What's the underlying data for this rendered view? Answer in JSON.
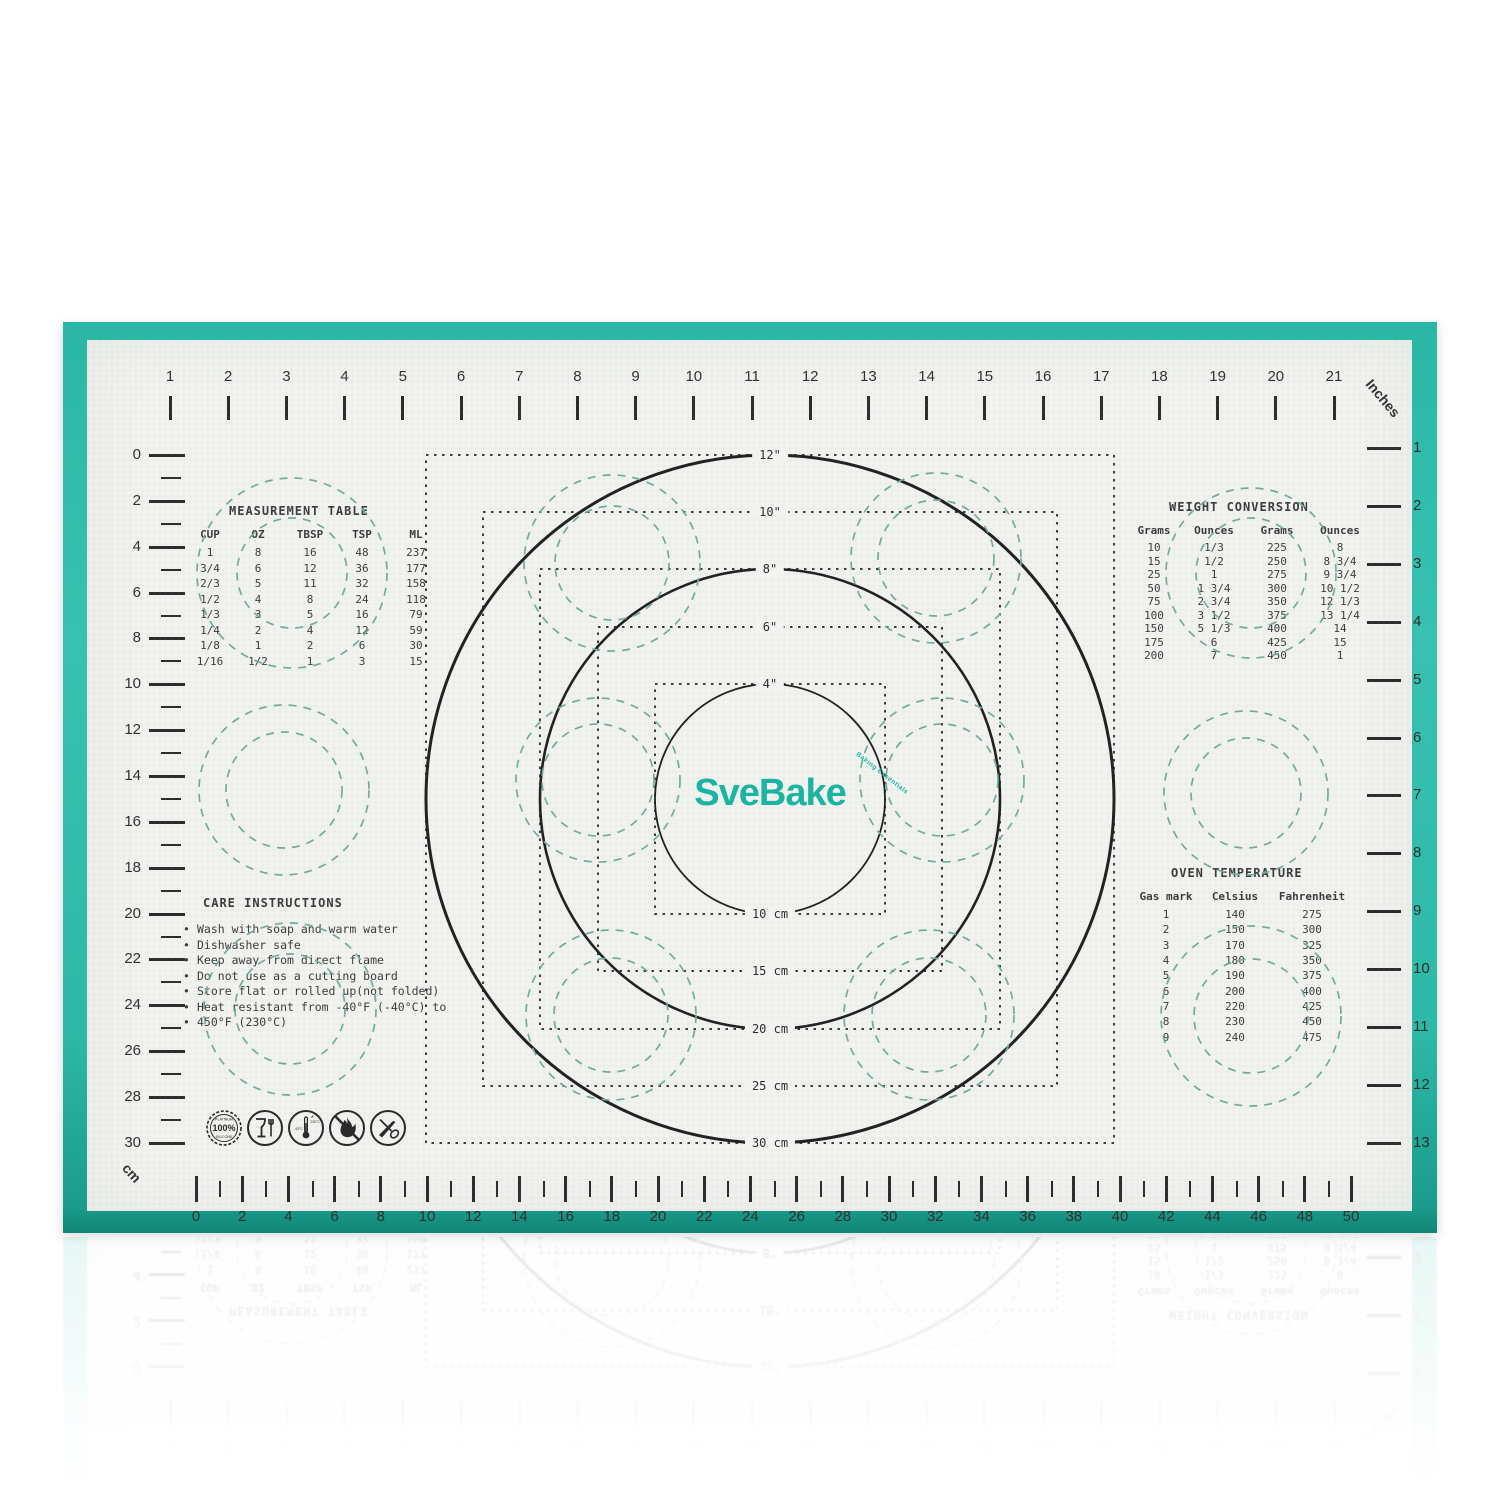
{
  "product": {
    "brand": "SveBake",
    "tagline": "Baking Essentials"
  },
  "colors": {
    "teal_border": "#2eb8a7",
    "mat_surface": "#f2f3f0",
    "ink": "#3a3a3a",
    "teal_dashed": "#76a99a",
    "logo_teal": "#1cb3a2"
  },
  "rulers": {
    "top_inches": {
      "unit_label": "Inches",
      "values": [
        1,
        2,
        3,
        4,
        5,
        6,
        7,
        8,
        9,
        10,
        11,
        12,
        13,
        14,
        15,
        16,
        17,
        18,
        19,
        20,
        21
      ]
    },
    "right_inches": {
      "values": [
        1,
        2,
        3,
        4,
        5,
        6,
        7,
        8,
        9,
        10,
        11,
        12,
        13
      ]
    },
    "left_cm": {
      "values": [
        0,
        2,
        4,
        6,
        8,
        10,
        12,
        14,
        16,
        18,
        20,
        22,
        24,
        26,
        28,
        30
      ]
    },
    "bottom_cm": {
      "unit_label": "cm",
      "values": [
        0,
        2,
        4,
        6,
        8,
        10,
        12,
        14,
        16,
        18,
        20,
        22,
        24,
        26,
        28,
        30,
        32,
        34,
        36,
        38,
        40,
        42,
        44,
        46,
        48,
        50
      ]
    }
  },
  "circle_labels": {
    "inches": [
      "12\"",
      "10\"",
      "8\"",
      "6\"",
      "4\""
    ],
    "cm": [
      "10 cm",
      "15 cm",
      "20 cm",
      "25 cm",
      "30 cm"
    ]
  },
  "measurement_table": {
    "title": "MEASUREMENT TABLE",
    "headers": [
      "CUP",
      "OZ",
      "TBSP",
      "TSP",
      "ML"
    ],
    "rows": [
      [
        "1",
        "8",
        "16",
        "48",
        "237"
      ],
      [
        "3/4",
        "6",
        "12",
        "36",
        "177"
      ],
      [
        "2/3",
        "5",
        "11",
        "32",
        "158"
      ],
      [
        "1/2",
        "4",
        "8",
        "24",
        "118"
      ],
      [
        "1/3",
        "3",
        "5",
        "16",
        "79"
      ],
      [
        "1/4",
        "2",
        "4",
        "12",
        "59"
      ],
      [
        "1/8",
        "1",
        "2",
        "6",
        "30"
      ],
      [
        "1/16",
        "1/2",
        "1",
        "3",
        "15"
      ]
    ]
  },
  "weight_conversion": {
    "title": "WEIGHT CONVERSION",
    "headers": [
      "Grams",
      "Ounces",
      "Grams",
      "Ounces"
    ],
    "rows": [
      [
        "10",
        "1/3",
        "225",
        "8"
      ],
      [
        "15",
        "1/2",
        "250",
        "8 3/4"
      ],
      [
        "25",
        "1",
        "275",
        "9 3/4"
      ],
      [
        "50",
        "1 3/4",
        "300",
        "10 1/2"
      ],
      [
        "75",
        "2 3/4",
        "350",
        "12 1/3"
      ],
      [
        "100",
        "3 1/2",
        "375",
        "13 1/4"
      ],
      [
        "150",
        "5 1/3",
        "400",
        "14"
      ],
      [
        "175",
        "6",
        "425",
        "15"
      ],
      [
        "200",
        "7",
        "450",
        "1"
      ]
    ]
  },
  "oven_temperature": {
    "title": "OVEN TEMPERATURE",
    "headers": [
      "Gas mark",
      "Celsius",
      "Fahrenheit"
    ],
    "rows": [
      [
        "1",
        "140",
        "275"
      ],
      [
        "2",
        "150",
        "300"
      ],
      [
        "3",
        "170",
        "325"
      ],
      [
        "4",
        "180",
        "350"
      ],
      [
        "5",
        "190",
        "375"
      ],
      [
        "6",
        "200",
        "400"
      ],
      [
        "7",
        "220",
        "425"
      ],
      [
        "8",
        "230",
        "450"
      ],
      [
        "9",
        "240",
        "475"
      ]
    ]
  },
  "care_instructions": {
    "title": "CARE INSTRUCTIONS",
    "items": [
      "Wash with soap and warm water",
      "Dishwasher safe",
      "Keep away from direct flame",
      "Do not use as a cutting board",
      "Store flat or rolled up(not folded)",
      "Heat resistant from -40°F (-40°C) to",
      "450°F (230°C)"
    ]
  },
  "badges": {
    "silicone": {
      "top": "PLATINUM",
      "value": "100%",
      "bottom": "SILICONE"
    },
    "icon_names": [
      "platinum-silicone-badge",
      "food-safe-icon",
      "temperature-range-icon",
      "no-open-flame-icon",
      "no-cutting-utensils-icon"
    ]
  }
}
